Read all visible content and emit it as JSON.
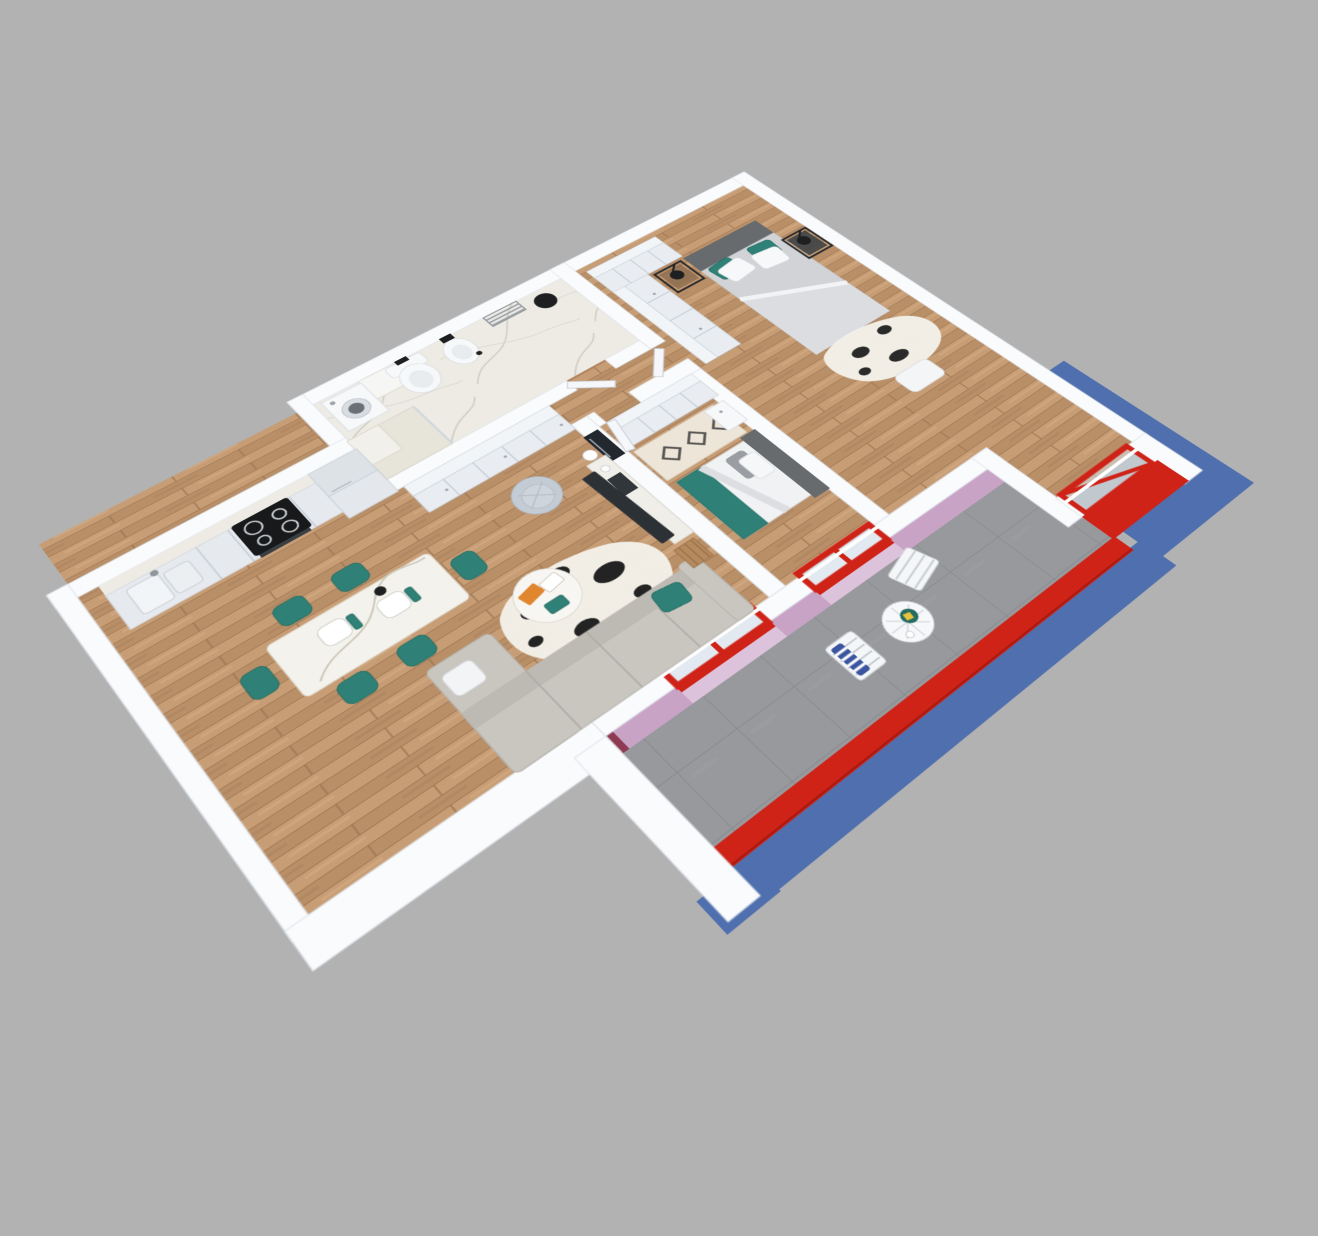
{
  "scene": {
    "type": "3d-apartment-floor-plan-render",
    "view": "isometric-top-perspective",
    "background": "#b2b2b2"
  },
  "colors": {
    "bg": "#b2b2b2",
    "wall": "#fafbfd",
    "wall-line": "#dde3ea",
    "wood": "#c1976f",
    "wood-d": "#a57c57",
    "wood-l": "#d2a97f",
    "marble": "#edebe4",
    "marble-v": "#c9c6ba",
    "tile": "#97999d",
    "tile-l": "#888a8e",
    "red": "#cf2318",
    "red-d": "#a81a10",
    "blue": "#4f6fae",
    "pink": "#c9a3c6",
    "pink-l": "#dcc2da",
    "maroon": "#8e3a52",
    "teal": "#2f8177",
    "teal-d": "#256b62",
    "sofa": "#c9c6c0",
    "bedgray": "#d2d3d6",
    "headboard": "#676b6e",
    "ink": "#1d1f20",
    "chrome": "#9aa0a6",
    "cream": "#ede5d8",
    "motif": "#3c3c3c"
  },
  "rooms": [
    {
      "name": "kitchen",
      "floor": "wood",
      "items": [
        {
          "name": "counter-run",
          "count": 1
        },
        {
          "name": "marble-backsplash",
          "count": 1
        },
        {
          "name": "induction-cooktop",
          "count": 1
        },
        {
          "name": "oven",
          "count": 1
        },
        {
          "name": "double-sink",
          "count": 1
        },
        {
          "name": "tall-cabinet-column",
          "count": 1
        }
      ]
    },
    {
      "name": "dining-area",
      "floor": "wood",
      "items": [
        {
          "name": "marble-dining-table",
          "count": 1
        },
        {
          "name": "teal-chair",
          "count": 6
        },
        {
          "name": "place-setting",
          "count": 2
        }
      ]
    },
    {
      "name": "living-room",
      "floor": "wood",
      "items": [
        {
          "name": "l-shaped-sofa",
          "count": 1
        },
        {
          "name": "teal-pillow",
          "count": 1
        },
        {
          "name": "cowhide-rug",
          "count": 1
        },
        {
          "name": "round-coffee-table",
          "count": 1
        },
        {
          "name": "magazines",
          "count": 3
        },
        {
          "name": "tv-console",
          "count": 1
        },
        {
          "name": "tv-screen",
          "count": 1
        },
        {
          "name": "wall-art",
          "count": 1
        },
        {
          "name": "table-lamp",
          "count": 1
        },
        {
          "name": "armchair",
          "count": 1
        },
        {
          "name": "magazine-rack",
          "count": 1
        }
      ]
    },
    {
      "name": "hallway",
      "floor": "wood",
      "items": [
        {
          "name": "built-in-wardrobe",
          "count": 1
        }
      ]
    },
    {
      "name": "bathroom",
      "floor": "marble",
      "items": [
        {
          "name": "washing-machine",
          "count": 1
        },
        {
          "name": "toilet",
          "count": 1
        },
        {
          "name": "bidet",
          "count": 1
        },
        {
          "name": "towel-radiator",
          "count": 1
        },
        {
          "name": "round-black-mirror",
          "count": 1
        },
        {
          "name": "marble-shower-column",
          "count": 1
        },
        {
          "name": "bathroom-door",
          "count": 1
        }
      ]
    },
    {
      "name": "bedroom-middle",
      "floor": "wood",
      "items": [
        {
          "name": "wardrobe",
          "count": 1
        },
        {
          "name": "bed",
          "count": 1
        },
        {
          "name": "dark-headboard",
          "count": 1
        },
        {
          "name": "teal-blanket",
          "count": 1
        },
        {
          "name": "berber-rug",
          "count": 1
        },
        {
          "name": "white-nightstand",
          "count": 1
        },
        {
          "name": "room-door",
          "count": 1
        },
        {
          "name": "red-window",
          "count": 1
        }
      ]
    },
    {
      "name": "bedroom-main",
      "floor": "wood",
      "items": [
        {
          "name": "l-shaped-wardrobe",
          "count": 2
        },
        {
          "name": "double-bed",
          "count": 1
        },
        {
          "name": "gray-headboard",
          "count": 1
        },
        {
          "name": "teal-pillow",
          "count": 2
        },
        {
          "name": "white-pillow",
          "count": 3
        },
        {
          "name": "metal-nightstand",
          "count": 2
        },
        {
          "name": "black-lamp",
          "count": 2
        },
        {
          "name": "cowhide-rug",
          "count": 1
        },
        {
          "name": "bench",
          "count": 1
        },
        {
          "name": "red-bay-window",
          "count": 1
        },
        {
          "name": "room-door",
          "count": 1
        }
      ]
    },
    {
      "name": "balcony",
      "floor": "gray-tile",
      "items": [
        {
          "name": "bistro-table",
          "count": 1
        },
        {
          "name": "folding-chair",
          "count": 2
        },
        {
          "name": "striped-towel",
          "count": 1
        },
        {
          "name": "teal-plate",
          "count": 1
        },
        {
          "name": "red-parapet",
          "count": 1
        },
        {
          "name": "blue-facade",
          "count": 1
        },
        {
          "name": "pink-wall-face",
          "count": 3
        },
        {
          "name": "red-window-frame",
          "count": 2
        },
        {
          "name": "glass-balustrade",
          "count": 2
        }
      ]
    }
  ]
}
